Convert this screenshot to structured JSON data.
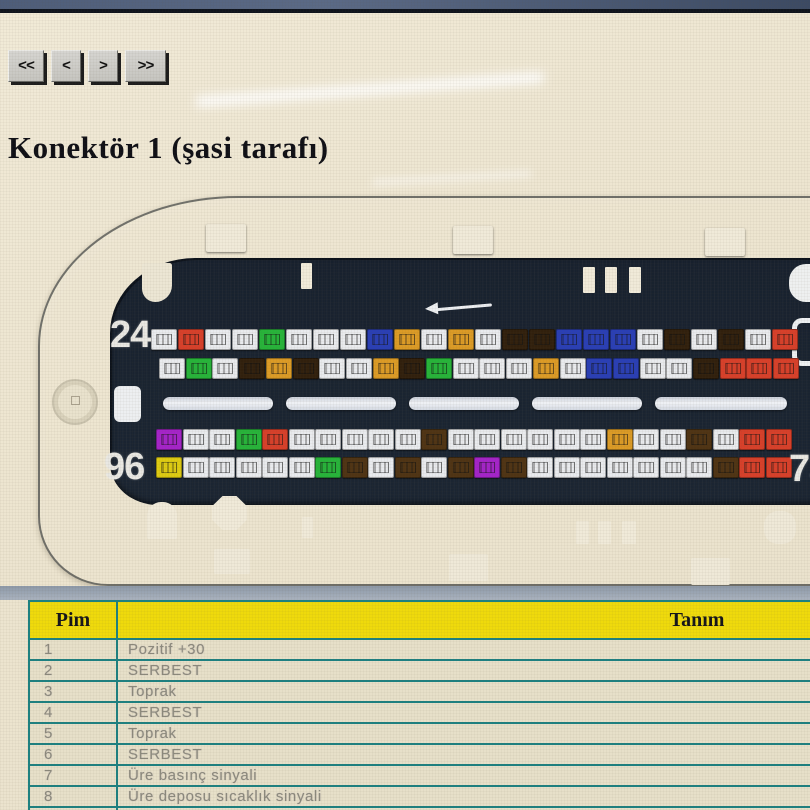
{
  "nav": {
    "first_label": "<<",
    "prev_label": "<",
    "next_label": ">",
    "last_label": ">>"
  },
  "page": {
    "title": "Konektör 1 (şasi tarafı)"
  },
  "connector": {
    "labels": {
      "top_left": "24",
      "bottom_left": "96",
      "bottom_right": "73"
    },
    "pin_palette": {
      "w": "#e9ebee",
      "r": "#d8402a",
      "g": "#27b43a",
      "bl": "#2a3fb5",
      "o": "#dc9b26",
      "db": "#31200d",
      "br": "#4f3414",
      "pu": "#a524c9",
      "y": "#decb12"
    },
    "pin_rows": [
      [
        "w",
        "r",
        "w",
        "w",
        "g",
        "w",
        "w",
        "w",
        "bl",
        "o",
        "w",
        "o",
        "w",
        "db",
        "db",
        "bl",
        "bl",
        "bl",
        "w",
        "db",
        "w",
        "db",
        "w",
        "r"
      ],
      [
        "w",
        "g",
        "w",
        "db",
        "o",
        "db",
        "w",
        "w",
        "o",
        "db",
        "g",
        "w",
        "w",
        "w",
        "o",
        "w",
        "bl",
        "bl",
        "w",
        "w",
        "db",
        "r",
        "r",
        "r"
      ],
      [
        "pu",
        "w",
        "w",
        "g",
        "r",
        "w",
        "w",
        "w",
        "w",
        "w",
        "br",
        "w",
        "w",
        "w",
        "w",
        "w",
        "w",
        "o",
        "w",
        "w",
        "br",
        "w",
        "r",
        "r"
      ],
      [
        "y",
        "w",
        "w",
        "w",
        "w",
        "w",
        "g",
        "br",
        "w",
        "br",
        "w",
        "br",
        "pu",
        "br",
        "w",
        "w",
        "w",
        "w",
        "w",
        "w",
        "w",
        "br",
        "r",
        "r"
      ]
    ]
  },
  "table": {
    "headers": {
      "pin": "Pim",
      "description": "Tanım"
    },
    "rows": [
      {
        "pin": "1",
        "description": "Pozitif +30"
      },
      {
        "pin": "2",
        "description": "SERBEST"
      },
      {
        "pin": "3",
        "description": "Toprak"
      },
      {
        "pin": "4",
        "description": "SERBEST"
      },
      {
        "pin": "5",
        "description": "Toprak"
      },
      {
        "pin": "6",
        "description": "SERBEST"
      },
      {
        "pin": "7",
        "description": "Üre basınç sinyali"
      },
      {
        "pin": "8",
        "description": "Üre deposu sıcaklık sinyali"
      },
      {
        "pin": "9",
        "description": "Katalitik"
      }
    ]
  }
}
